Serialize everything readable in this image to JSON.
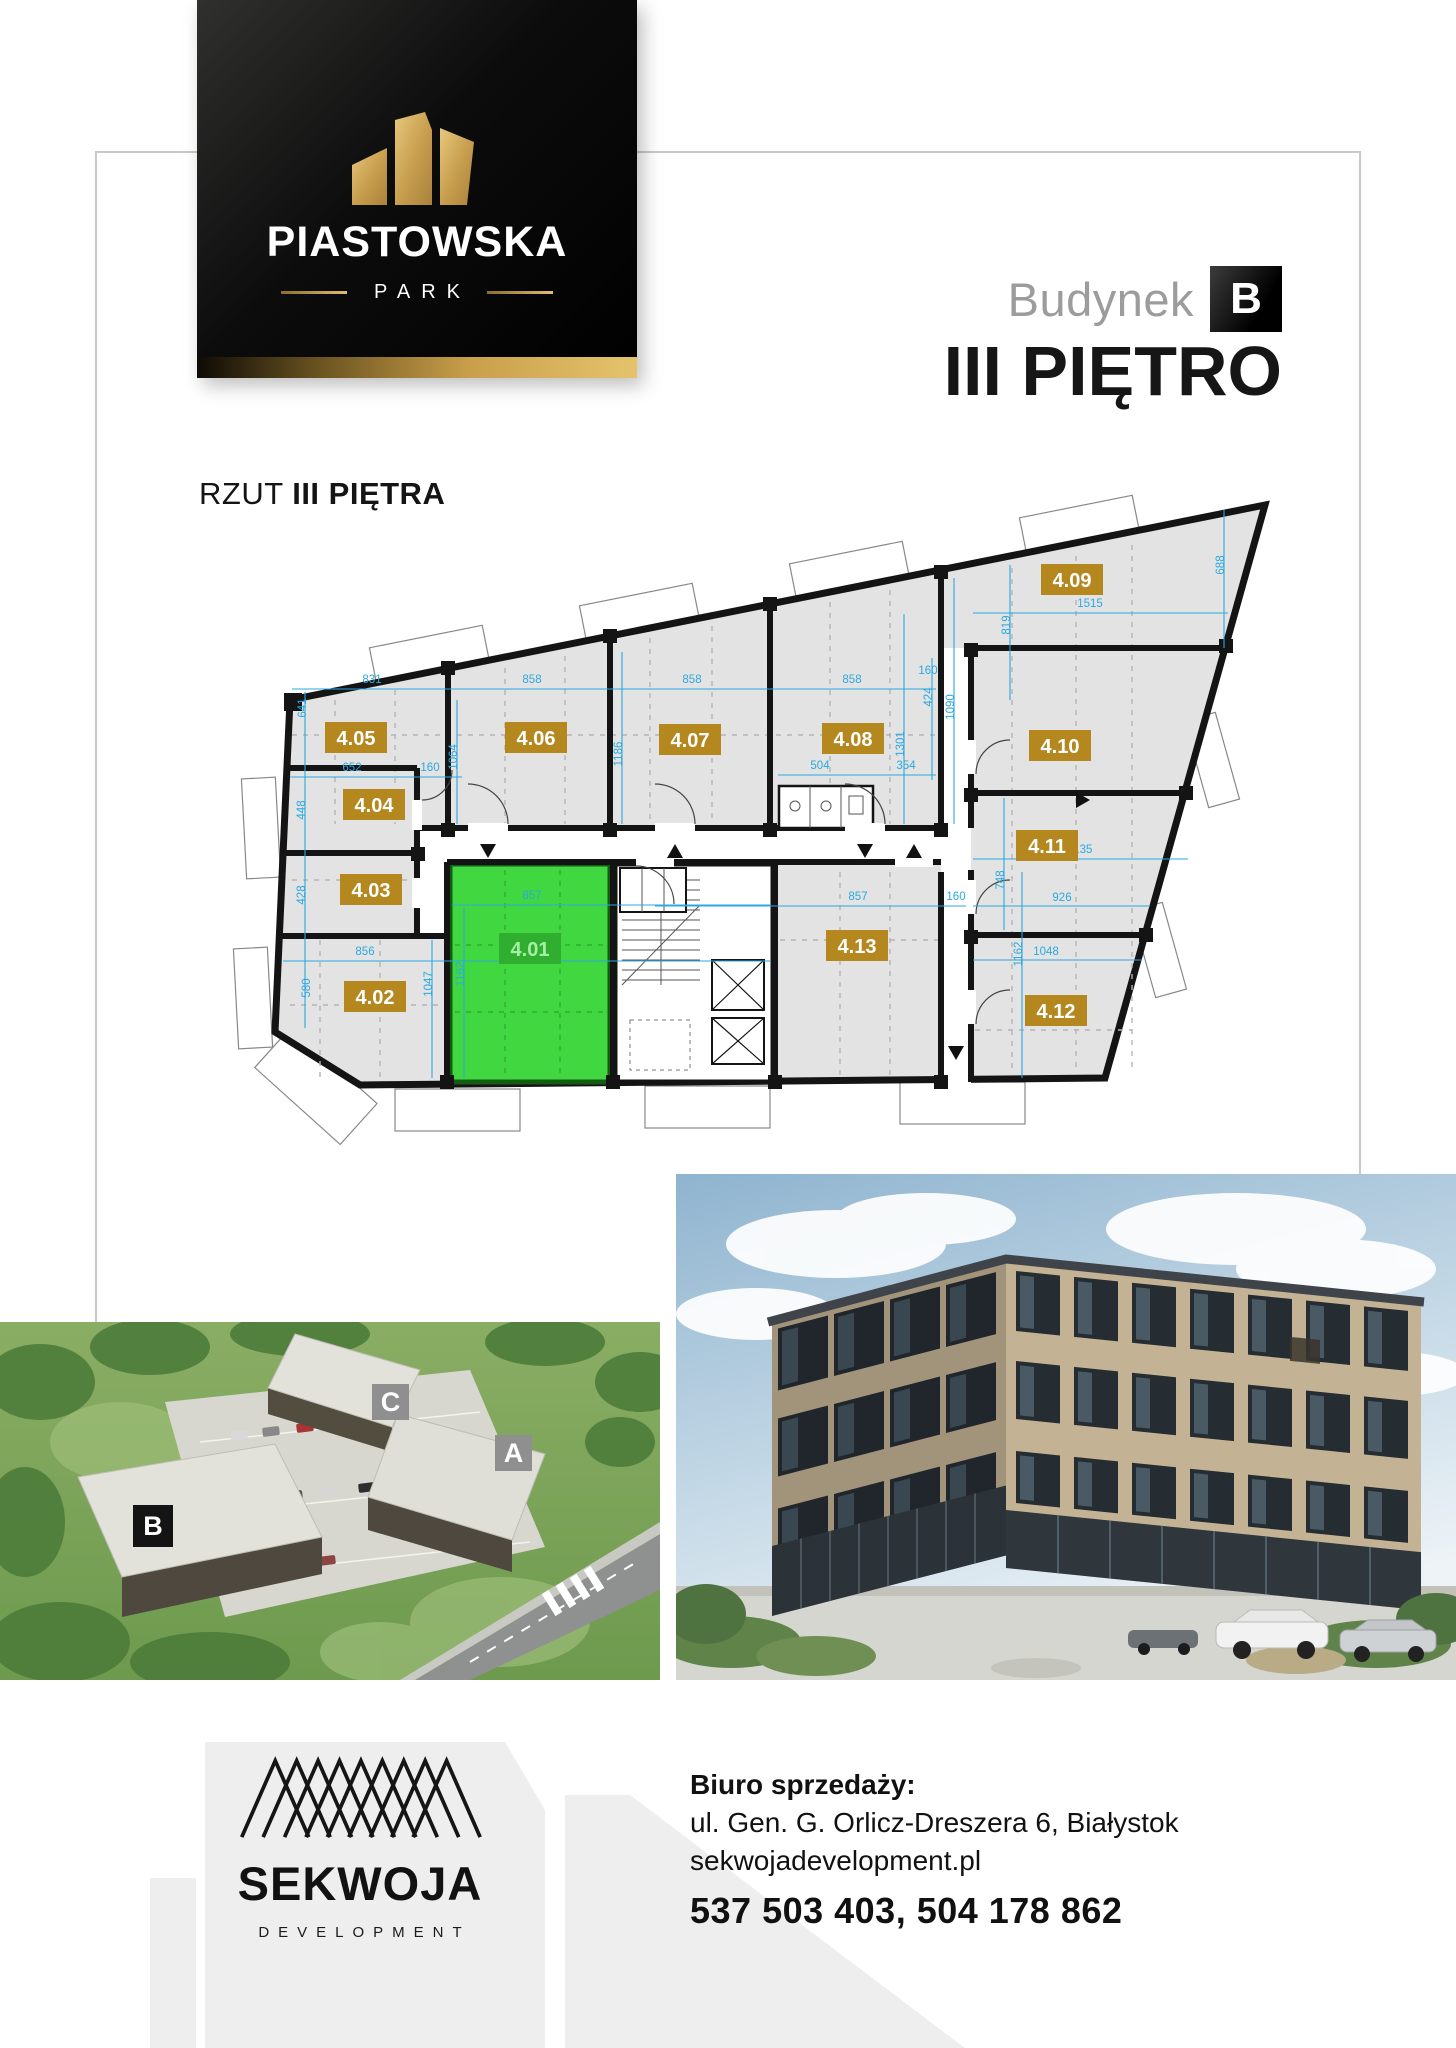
{
  "logo_card": {
    "brand": "PIASTOWSKA",
    "sub": "PARK"
  },
  "header": {
    "building_label": "Budynek",
    "building_letter": "B",
    "floor_title": "III PIĘTRO"
  },
  "plan": {
    "caption_prefix": "RZUT ",
    "caption_bold": "III PIĘTRA",
    "units": [
      {
        "id": "4.01",
        "x": 530,
        "y": 949,
        "hl": true
      },
      {
        "id": "4.02",
        "x": 375,
        "y": 997,
        "hl": false
      },
      {
        "id": "4.03",
        "x": 371,
        "y": 890,
        "hl": false
      },
      {
        "id": "4.04",
        "x": 374,
        "y": 805,
        "hl": false
      },
      {
        "id": "4.05",
        "x": 356,
        "y": 738,
        "hl": false
      },
      {
        "id": "4.06",
        "x": 536,
        "y": 738,
        "hl": false
      },
      {
        "id": "4.07",
        "x": 690,
        "y": 740,
        "hl": false
      },
      {
        "id": "4.08",
        "x": 853,
        "y": 739,
        "hl": false
      },
      {
        "id": "4.09",
        "x": 1072,
        "y": 580,
        "hl": false
      },
      {
        "id": "4.10",
        "x": 1060,
        "y": 746,
        "hl": false
      },
      {
        "id": "4.11",
        "x": 1047,
        "y": 846,
        "hl": false
      },
      {
        "id": "4.12",
        "x": 1056,
        "y": 1011,
        "hl": false
      },
      {
        "id": "4.13",
        "x": 857,
        "y": 946,
        "hl": false
      }
    ],
    "dims": [
      {
        "t": "831",
        "x": 372,
        "y": 683
      },
      {
        "t": "858",
        "x": 532,
        "y": 683
      },
      {
        "t": "858",
        "x": 692,
        "y": 683
      },
      {
        "t": "858",
        "x": 852,
        "y": 683
      },
      {
        "t": "160",
        "x": 928,
        "y": 674
      },
      {
        "t": "1515",
        "x": 1090,
        "y": 607
      },
      {
        "t": "688",
        "x": 1224,
        "y": 565,
        "v": 1
      },
      {
        "t": "819",
        "x": 1010,
        "y": 625,
        "v": 1
      },
      {
        "t": "641",
        "x": 306,
        "y": 708,
        "v": 1
      },
      {
        "t": "1064",
        "x": 457,
        "y": 757,
        "v": 1
      },
      {
        "t": "1186",
        "x": 622,
        "y": 754,
        "v": 1
      },
      {
        "t": "1301",
        "x": 904,
        "y": 744,
        "v": 1
      },
      {
        "t": "1090",
        "x": 954,
        "y": 707,
        "v": 1
      },
      {
        "t": "424",
        "x": 932,
        "y": 697,
        "v": 1
      },
      {
        "t": "652",
        "x": 352,
        "y": 771
      },
      {
        "t": "160",
        "x": 430,
        "y": 771
      },
      {
        "t": "448",
        "x": 305,
        "y": 810,
        "v": 1
      },
      {
        "t": "428",
        "x": 305,
        "y": 895,
        "v": 1
      },
      {
        "t": "580",
        "x": 310,
        "y": 988,
        "v": 1
      },
      {
        "t": "856",
        "x": 365,
        "y": 955
      },
      {
        "t": "1047",
        "x": 432,
        "y": 984,
        "v": 1
      },
      {
        "t": "1162",
        "x": 464,
        "y": 974,
        "v": 1
      },
      {
        "t": "857",
        "x": 532,
        "y": 899
      },
      {
        "t": "857",
        "x": 858,
        "y": 900
      },
      {
        "t": "160",
        "x": 956,
        "y": 900
      },
      {
        "t": "1162",
        "x": 1022,
        "y": 954,
        "v": 1
      },
      {
        "t": "748",
        "x": 1004,
        "y": 880,
        "v": 1
      },
      {
        "t": "1135",
        "x": 1080,
        "y": 853
      },
      {
        "t": "926",
        "x": 1062,
        "y": 901
      },
      {
        "t": "1048",
        "x": 1046,
        "y": 955
      },
      {
        "t": "504",
        "x": 820,
        "y": 769
      },
      {
        "t": "354",
        "x": 906,
        "y": 769
      }
    ],
    "dim_lines": [
      [
        292,
        689,
        936,
        689
      ],
      [
        973,
        613,
        1228,
        613
      ],
      [
        973,
        859,
        1188,
        859
      ],
      [
        973,
        906,
        1150,
        906
      ],
      [
        973,
        960,
        1142,
        960
      ],
      [
        655,
        906,
        966,
        906
      ],
      [
        452,
        905,
        770,
        905
      ],
      [
        283,
        961,
        770,
        961
      ],
      [
        290,
        777,
        462,
        777
      ],
      [
        778,
        775,
        936,
        775
      ],
      [
        305,
        692,
        305,
        1028
      ],
      [
        457,
        700,
        457,
        824
      ],
      [
        622,
        652,
        622,
        824
      ],
      [
        904,
        614,
        904,
        824
      ],
      [
        954,
        578,
        954,
        824
      ],
      [
        1010,
        565,
        1010,
        700
      ],
      [
        1224,
        510,
        1224,
        648
      ],
      [
        432,
        940,
        432,
        1078
      ],
      [
        464,
        908,
        464,
        1078
      ],
      [
        1022,
        872,
        1022,
        1078
      ],
      [
        1004,
        798,
        1004,
        930
      ],
      [
        932,
        658,
        932,
        780
      ]
    ],
    "colors": {
      "unit_gold": "#b5871f",
      "highlight_fill": "#41d741",
      "highlight_dark": "#2fae2f",
      "highlight_text": "#a5efa5",
      "dimension_blue": "#2aa9e0",
      "floor_fill": "#e3e3e3",
      "wall": "#141414",
      "frame_gray": "#c9c9c9"
    }
  },
  "site_view": {
    "labels": [
      {
        "t": "C",
        "x": 372,
        "y": 1384,
        "w": 37,
        "h": 36,
        "bg": "#8f8f8f"
      },
      {
        "t": "A",
        "x": 495,
        "y": 1435,
        "w": 37,
        "h": 36,
        "bg": "#8f8f8f"
      },
      {
        "t": "B",
        "x": 133,
        "y": 1505,
        "w": 40,
        "h": 42,
        "bg": "#141414"
      }
    ]
  },
  "footer": {
    "office_label": "Biuro sprzedaży:",
    "address": "ul. Gen. G. Orlicz-Dreszera 6, Białystok",
    "website": "sekwojadevelopment.pl",
    "phones": "537 503 403, 504 178 862",
    "brand": "SEKWOJA",
    "brand_sub": "DEVELOPMENT"
  }
}
